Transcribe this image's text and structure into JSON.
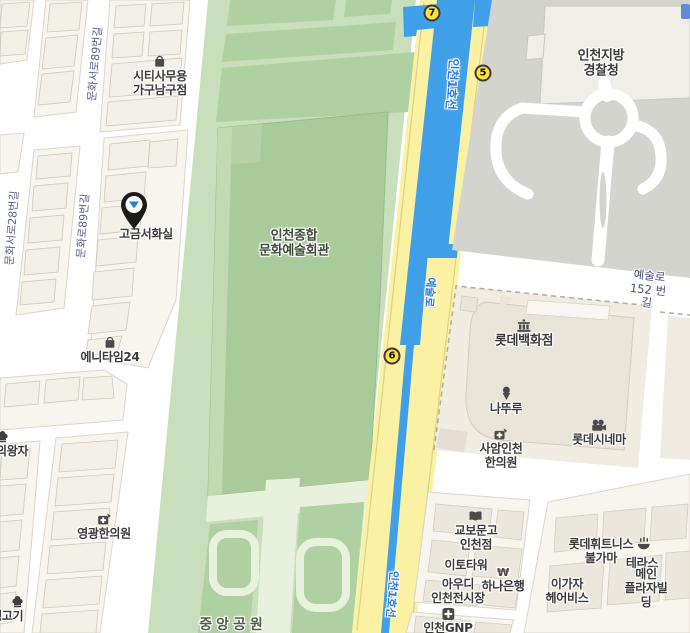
{
  "transit": {
    "line_label": "인천1호선",
    "yesul_street": "예술로",
    "stations": {
      "s7": "7",
      "s5": "5",
      "s6": "6"
    }
  },
  "streets": {
    "munhwaseoro28": "문화서로28번길",
    "munhwaseoro89": "문화서로89번길",
    "munhwaro89": "문화로89번길",
    "yesulro152": "예술로152 번길"
  },
  "areas": {
    "arts_center": "인천종합\n문화예술회관",
    "central_park": "중앙공원",
    "police": "인천지방\n경찰청"
  },
  "pois": {
    "citi": {
      "name": "시티사무용\n가구남구점",
      "icon": "shopping-bag"
    },
    "gogeum": {
      "name": "고금서화실",
      "icon": "map-pin"
    },
    "anytime": {
      "name": "에니타임24",
      "icon": "shopping-bag"
    },
    "uiwangja": {
      "name": "의왕자",
      "icon": "restaurant"
    },
    "yeonggwang": {
      "name": "영광한의원",
      "icon": "oriental-clinic"
    },
    "saengogi": {
      "name": "생고기",
      "icon": "restaurant"
    },
    "lotte_dept": {
      "name": "롯데백화점",
      "icon": "department-store"
    },
    "natuur": {
      "name": "나뚜루",
      "icon": "ice-cream"
    },
    "saam": {
      "name": "사암인천\n한의원",
      "icon": "oriental-clinic"
    },
    "lotte_cinema": {
      "name": "롯데시네마",
      "icon": "cinema"
    },
    "kyobo": {
      "name": "교보문고\n인천점",
      "icon": "book"
    },
    "eto": {
      "name": "이토타워"
    },
    "audi": {
      "name": "아우디\n인천전시장"
    },
    "hana": {
      "name": "하나은행",
      "icon": "won-currency"
    },
    "gnp": {
      "name": "인천GNP",
      "icon": "clinic"
    },
    "fitness": {
      "name": "롯데휘트니스\n불가마",
      "icon": "sauna"
    },
    "terrace": {
      "name": "테라스"
    },
    "igaja": {
      "name": "이가자\n헤어비스"
    },
    "mainplaza": {
      "name": "메인\n플라자빌딩"
    }
  },
  "colors": {
    "subway_line": "#3FA0E8",
    "road_yellow": "#FAF1A2",
    "park_green": "#C9DFBB",
    "lawn_green": "#AFD0A0",
    "station_badge": "#FFE13F",
    "transit_text": "#2E7AD9",
    "street_text": "#59628C",
    "poi_text": "#3B3B3B"
  }
}
